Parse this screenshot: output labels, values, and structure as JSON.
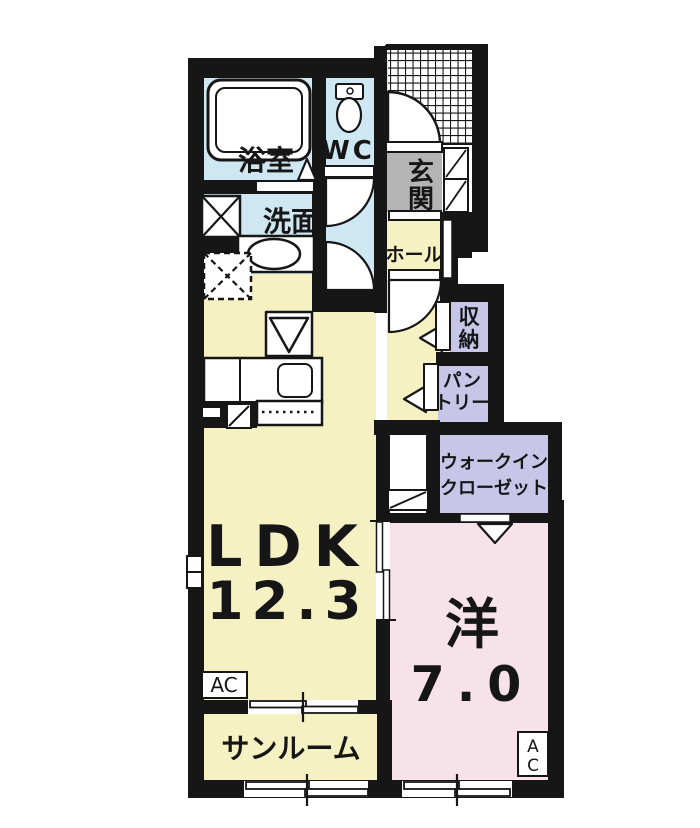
{
  "plan": {
    "labels": {
      "bath": "浴室",
      "wc": "WC",
      "washroom": "洗面",
      "entrance_char1": "玄",
      "entrance_char2": "関",
      "hall": "ホール",
      "storage_char1": "収",
      "storage_char2": "納",
      "pantry_line1": "パン",
      "pantry_line2": "トリー",
      "wic_line1": "ウォークイン",
      "wic_line2": "クローゼット",
      "ldk_name": "LDK",
      "ldk_size": "12.3",
      "western_name": "洋",
      "western_size": "7.0",
      "sunroom": "サンルーム",
      "ac_ldk": "AC",
      "ac_western_char1": "A",
      "ac_western_char2": "C"
    },
    "colors": {
      "wall": "#161616",
      "wet_rooms": "#cfe7f3",
      "living_rooms": "#f6f1c3",
      "bedroom": "#f8e2ea",
      "storage_rooms": "#c7c6e9",
      "entrance_floor": "#b4b4b4"
    }
  }
}
